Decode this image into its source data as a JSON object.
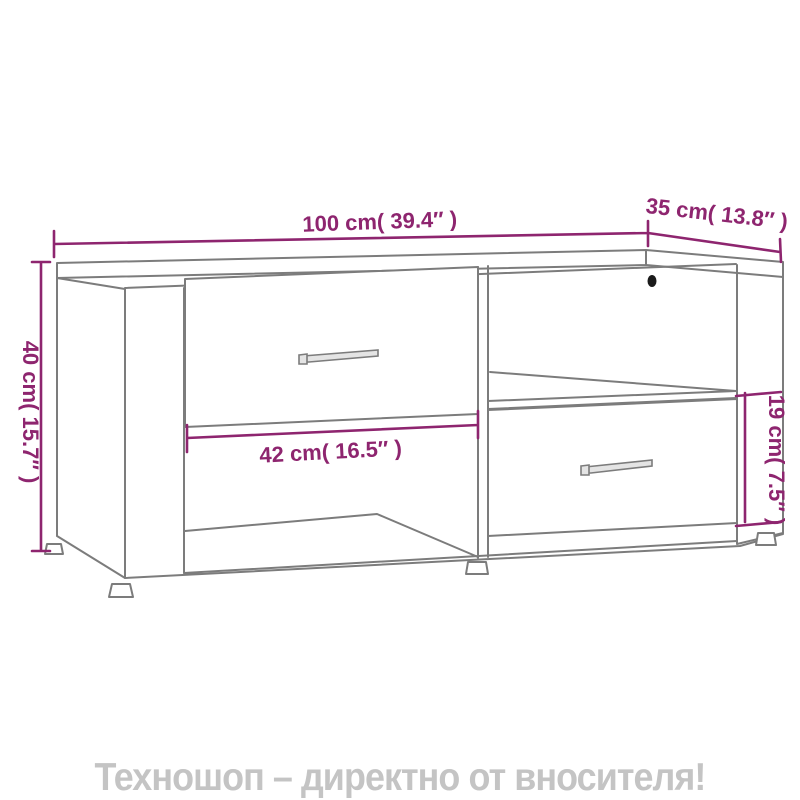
{
  "product_diagram": {
    "type": "furniture-dimension-diagram",
    "item": "tv-cabinet-with-two-drawers-and-open-shelves"
  },
  "dimensions": {
    "width": {
      "label": "100 cm( 39.4″ )",
      "cm": 100,
      "inches": 39.4
    },
    "depth": {
      "label": "35 cm( 13.8″ )",
      "cm": 35,
      "inches": 13.8
    },
    "height": {
      "label": "40 cm( 15.7″ )",
      "cm": 40,
      "inches": 15.7
    },
    "inner_width": {
      "label": "42 cm( 16.5″ )",
      "cm": 42,
      "inches": 16.5
    },
    "inner_height": {
      "label": "19 cm( 7.5″ )",
      "cm": 19,
      "inches": 7.5
    }
  },
  "banner": {
    "text": "Техношоп – директно от вносителя!"
  },
  "colors": {
    "dimension_accent": "#8e256f",
    "line_art": "#7c7c7c",
    "banner_text": "#c4c4c4",
    "cable_hole": "#1a1a1a",
    "background": "#ffffff"
  }
}
